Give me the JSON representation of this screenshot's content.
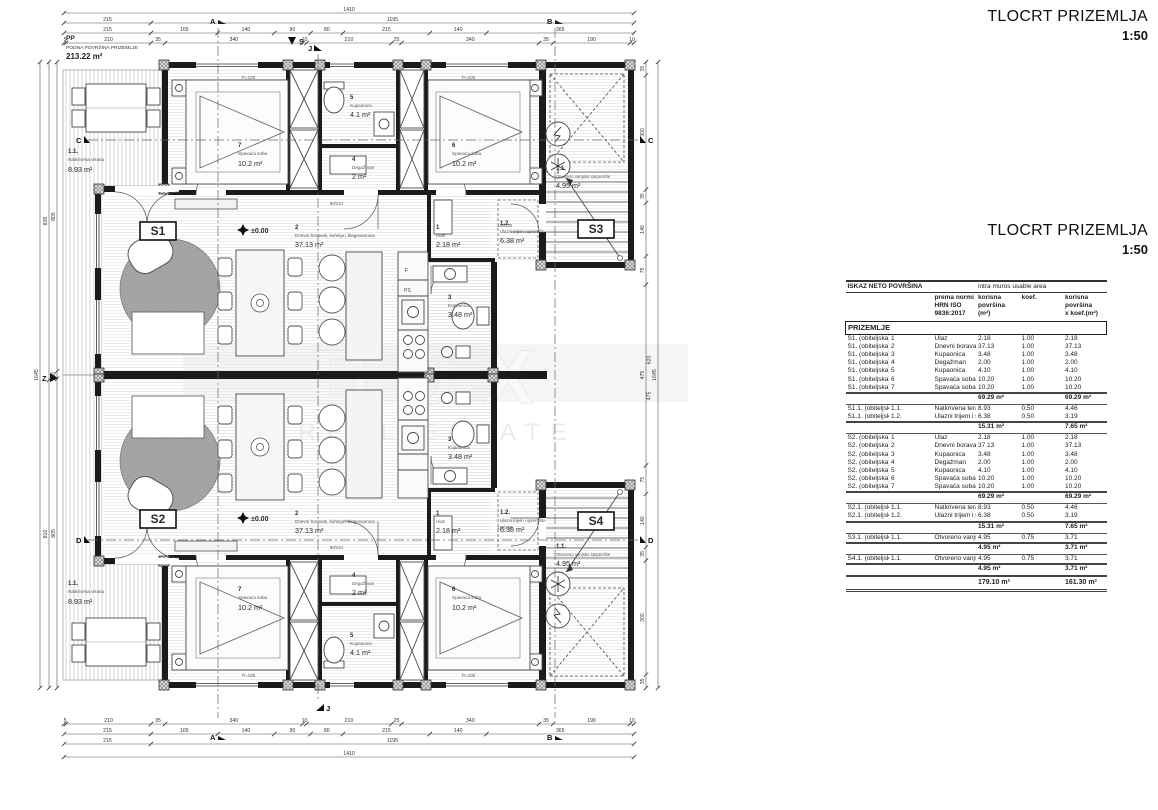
{
  "title": {
    "text": "TLOCRT PRIZEMLJA",
    "scale": "1:50"
  },
  "watermark": {
    "line1": "DUX",
    "line2": "REAL ESTATE"
  },
  "plan": {
    "pp": "PP",
    "floor_area_title": "PODNA POVRŠINA PRIZEMLJE",
    "floor_area_value": "213.22 m²",
    "level": "±0.00",
    "parapet": "P=100",
    "entry_door_dim": "140/220",
    "deg_door_dim": "90/210",
    "kitchen_tags": {
      "f": "F",
      "ps": "PS"
    },
    "unit_tags": {
      "s1": "S1",
      "s2": "S2",
      "s3": "S3",
      "s4": "S4"
    },
    "markers": {
      "a": "A",
      "b": "B",
      "c": "C",
      "d": "D",
      "j": "J",
      "north": "S",
      "west": "Z"
    },
    "rooms": {
      "ulaz": {
        "num": "1",
        "name": "Ulaz",
        "area": "2.18 m²"
      },
      "dnevni": {
        "num": "2",
        "name": "Dnevni boravak, kuhinja i blagovaonica",
        "area": "37.13 m²"
      },
      "kupaonica3": {
        "num": "3",
        "name": "Kupaonica",
        "area": "3.48 m²"
      },
      "degazman": {
        "num": "4",
        "name": "Degažman",
        "area": "2 m²"
      },
      "kupaonica5": {
        "num": "5",
        "name": "Kupaonica",
        "area": "4.1 m²"
      },
      "spavaca6": {
        "num": "6",
        "name": "Spavaća soba",
        "area": "10.2 m²"
      },
      "spavaca7": {
        "num": "7",
        "name": "Spavaća soba",
        "area": "10.2 m²"
      },
      "terasa": {
        "num": "1.1.",
        "name": "Natkrivena terasa",
        "area": "8.93 m²"
      },
      "trijem": {
        "num": "1.2.",
        "name": "Ulazni trijem i spremište",
        "area": "6.38 m²"
      },
      "stepeniste": {
        "num": "1.1.",
        "name": "Otvoreno vanjsko stepenište",
        "area": "4.95 m²"
      }
    },
    "dims": {
      "top": [
        [
          "1410"
        ],
        [
          "215",
          "1195"
        ],
        [
          "215",
          "165",
          "140",
          "90",
          "80",
          "215",
          "140",
          "365"
        ],
        [
          "5",
          "210",
          "35",
          "340",
          "10",
          "210",
          "25",
          "340",
          "35",
          "190",
          "10"
        ]
      ],
      "bottom": [
        [
          "5",
          "210",
          "35",
          "340",
          "10",
          "210",
          "25",
          "340",
          "35",
          "190",
          "10"
        ],
        [
          "215",
          "165",
          "140",
          "90",
          "80",
          "215",
          "140",
          "365"
        ],
        [
          "215",
          "1195"
        ],
        [
          "1410"
        ]
      ],
      "left": [
        [
          "1645"
        ],
        [
          "835",
          "810"
        ],
        [
          "805",
          "20",
          "805"
        ]
      ],
      "right": [
        [
          "35",
          "300",
          "35",
          "140",
          "75",
          "475",
          "75",
          "140",
          "35",
          "300",
          "35"
        ],
        [
          "1645"
        ]
      ],
      "right_extra": [
        "620",
        "475"
      ]
    }
  },
  "table": {
    "header": {
      "title_hr": "ISKAZ NETO POVRŠINA",
      "title_en": "intra muros usable area",
      "norm": "prema normi\nHRN ISO 9836:2017",
      "col_area": "korisna\npovršina (m²)",
      "col_koef": "koef.",
      "col_area_koef": "korisna površina\nx koef.(m²)",
      "section": "PRIZEMLJE"
    },
    "groups": [
      {
        "rows": [
          [
            "S1. (obiteljska)",
            "1",
            "Ulaz",
            "2.18",
            "1.00",
            "2.18"
          ],
          [
            "S1. (obiteljska)",
            "2",
            "Dnevni boravak, kuhinja i blagovaonica",
            "37.13",
            "1.00",
            "37.13"
          ],
          [
            "S1. (obiteljska)",
            "3",
            "Kupaonica",
            "3.48",
            "1.00",
            "3.48"
          ],
          [
            "S1. (obiteljska)",
            "4",
            "Degažman",
            "2.00",
            "1.00",
            "2.00"
          ],
          [
            "S1. (obiteljska)",
            "5",
            "Kupaonica",
            "4.10",
            "1.00",
            "4.10"
          ],
          [
            "S1. (obiteljska)",
            "6",
            "Spavaća soba",
            "10.20",
            "1.00",
            "10.20"
          ],
          [
            "S1. (obiteljska)",
            "7",
            "Spavaća soba",
            "10.20",
            "1.00",
            "10.20"
          ]
        ],
        "subtotal": [
          "69.29 m²",
          "69.29 m²"
        ]
      },
      {
        "rows": [
          [
            "S1.1. (obiteljska)",
            "1.1.",
            "Natkrivena terasa",
            "8.93",
            "0.50",
            "4.46"
          ],
          [
            "S1.1. (obiteljska)",
            "1.2.",
            "Ulazni trijem i spremište",
            "6.38",
            "0.50",
            "3.19"
          ]
        ],
        "subtotal": [
          "15.31 m²",
          "7.65 m²"
        ]
      },
      {
        "rows": [
          [
            "S2. (obiteljska)",
            "1",
            "Ulaz",
            "2.18",
            "1.00",
            "2.18"
          ],
          [
            "S2. (obiteljska)",
            "2",
            "Dnevni boravak, kuhinja i blagovaonica",
            "37.13",
            "1.00",
            "37.13"
          ],
          [
            "S2. (obiteljska)",
            "3",
            "Kupaonica",
            "3.48",
            "1.00",
            "3.48"
          ],
          [
            "S2. (obiteljska)",
            "4",
            "Degažman",
            "2.00",
            "1.00",
            "2.00"
          ],
          [
            "S2. (obiteljska)",
            "5",
            "Kupaonica",
            "4.10",
            "1.00",
            "4.10"
          ],
          [
            "S2. (obiteljska)",
            "6",
            "Spavaća soba",
            "10.20",
            "1.00",
            "10.20"
          ],
          [
            "S2. (obiteljska)",
            "7",
            "Spavaća soba",
            "10.20",
            "1.00",
            "10.20"
          ]
        ],
        "subtotal": [
          "69.29 m²",
          "69.29 m²"
        ]
      },
      {
        "rows": [
          [
            "S2.1. (obiteljska)",
            "1.1.",
            "Natkrivena terasa",
            "8.93",
            "0.50",
            "4.46"
          ],
          [
            "S2.1. (obiteljska)",
            "1.2.",
            "Ulazni trijem i spremište",
            "6.38",
            "0.50",
            "3.19"
          ]
        ],
        "subtotal": [
          "15.31 m²",
          "7.65 m²"
        ]
      },
      {
        "rows": [
          [
            "S3.1. (obiteljska)",
            "1.1.",
            "Otvoreno vanjsko stepenište",
            "4.95",
            "0.75",
            "3.71"
          ]
        ],
        "subtotal": [
          "4.95 m²",
          "3.71 m²"
        ]
      },
      {
        "rows": [
          [
            "S4.1. (obiteljska)",
            "1.1.",
            "Otvoreno vanjsko stepenište",
            "4.95",
            "0.75",
            "3.71"
          ]
        ],
        "subtotal": [
          "4.95 m²",
          "3.71 m²"
        ]
      }
    ],
    "total": [
      "179.10 m²",
      "161.30 m²"
    ]
  }
}
